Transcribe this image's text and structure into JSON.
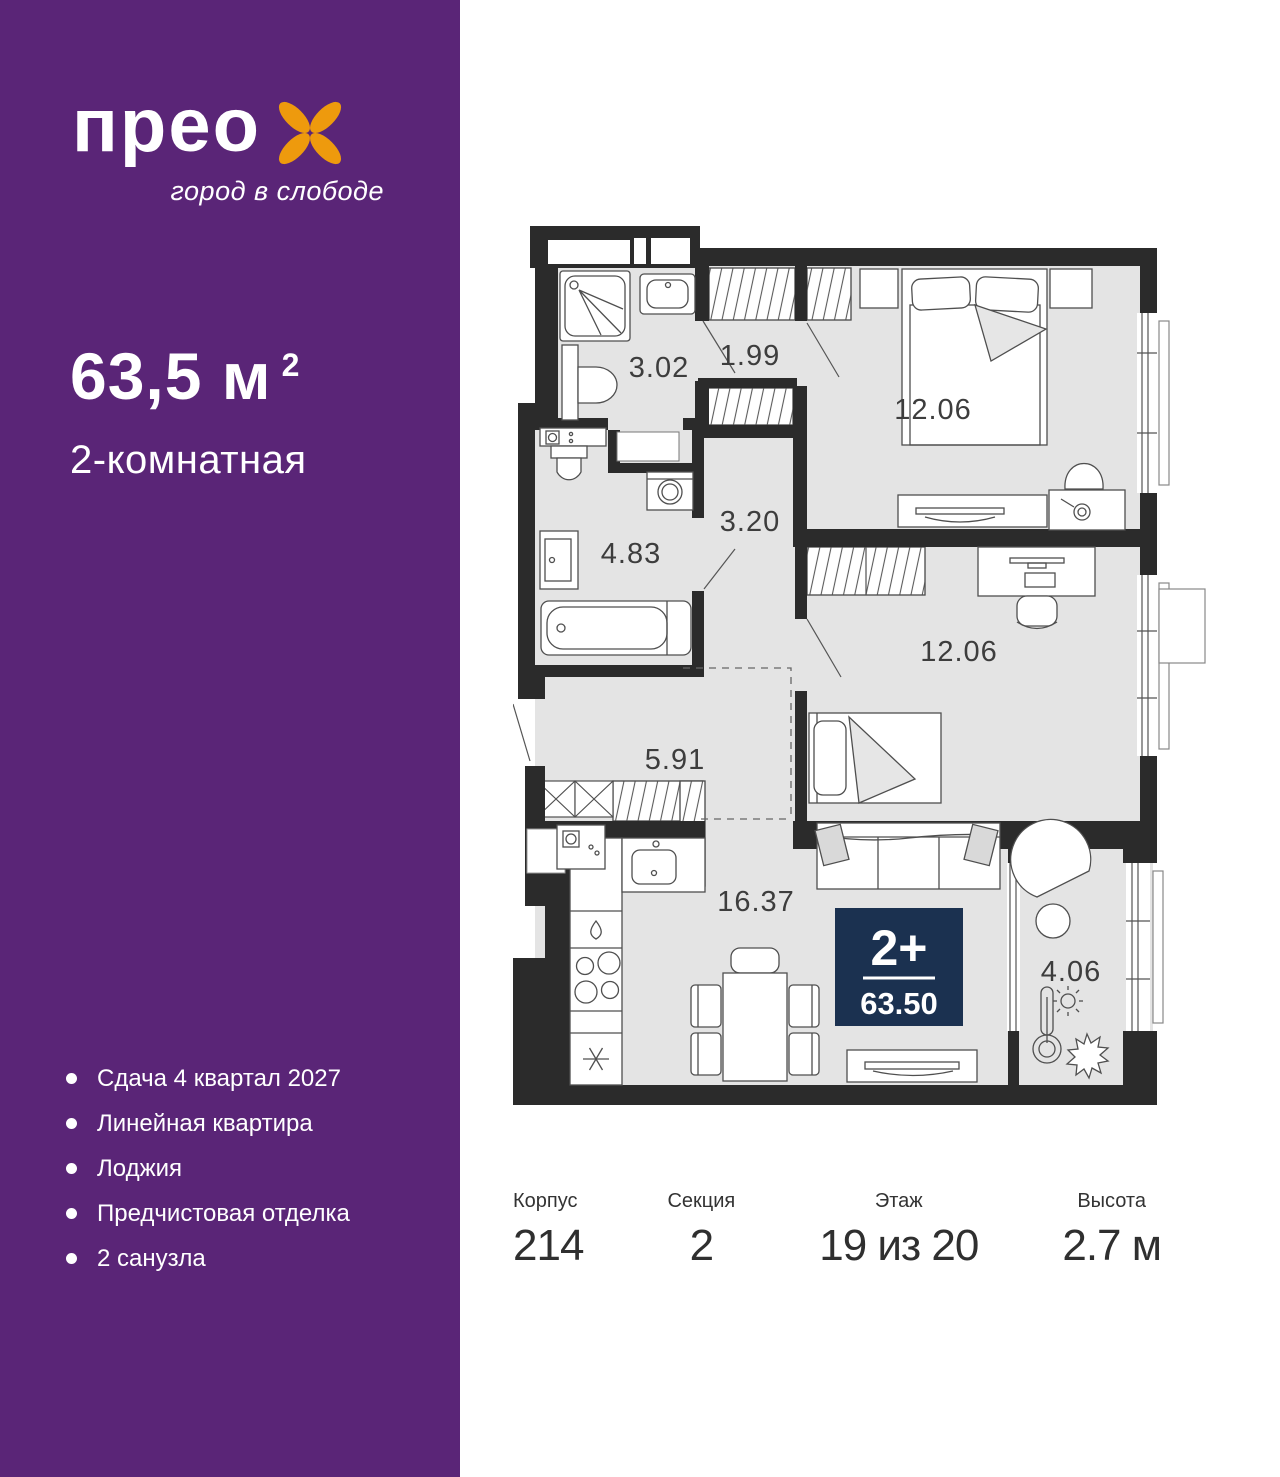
{
  "brand": {
    "logo_text": "прео",
    "tagline": "город в слободе",
    "flower_color": "#ee9a0d"
  },
  "sidebar": {
    "area_value": "63,5 м",
    "area_sup": "2",
    "rooms_label": "2-комнатная",
    "features": [
      "Сдача 4 квартал 2027",
      "Линейная квартира",
      "Лоджия",
      "Предчистовая отделка",
      "2 санузла"
    ]
  },
  "floorplan": {
    "rooms": {
      "shower_bathroom": "3.02",
      "wardrobe_hall": "1.99",
      "inner_hall": "3.20",
      "bathroom": "4.83",
      "bedroom_1": "12.06",
      "bedroom_2": "12.06",
      "hallway": "5.91",
      "kitchen_living": "16.37",
      "loggia": "4.06"
    },
    "badge": {
      "rooms_label": "2+",
      "total_area": "63.50"
    }
  },
  "details": {
    "columns": [
      {
        "label": "Корпус",
        "value": "214"
      },
      {
        "label": "Секция",
        "value": "2"
      },
      {
        "label": "Этаж",
        "value": "19 из 20"
      },
      {
        "label": "Высота",
        "value": "2.7 м"
      }
    ]
  },
  "colors": {
    "purple": "#5a2577",
    "orange": "#ee9a0d",
    "wall": "#2b2b2b",
    "floor": "#e4e4e4",
    "badge_bg": "#1b3150"
  }
}
